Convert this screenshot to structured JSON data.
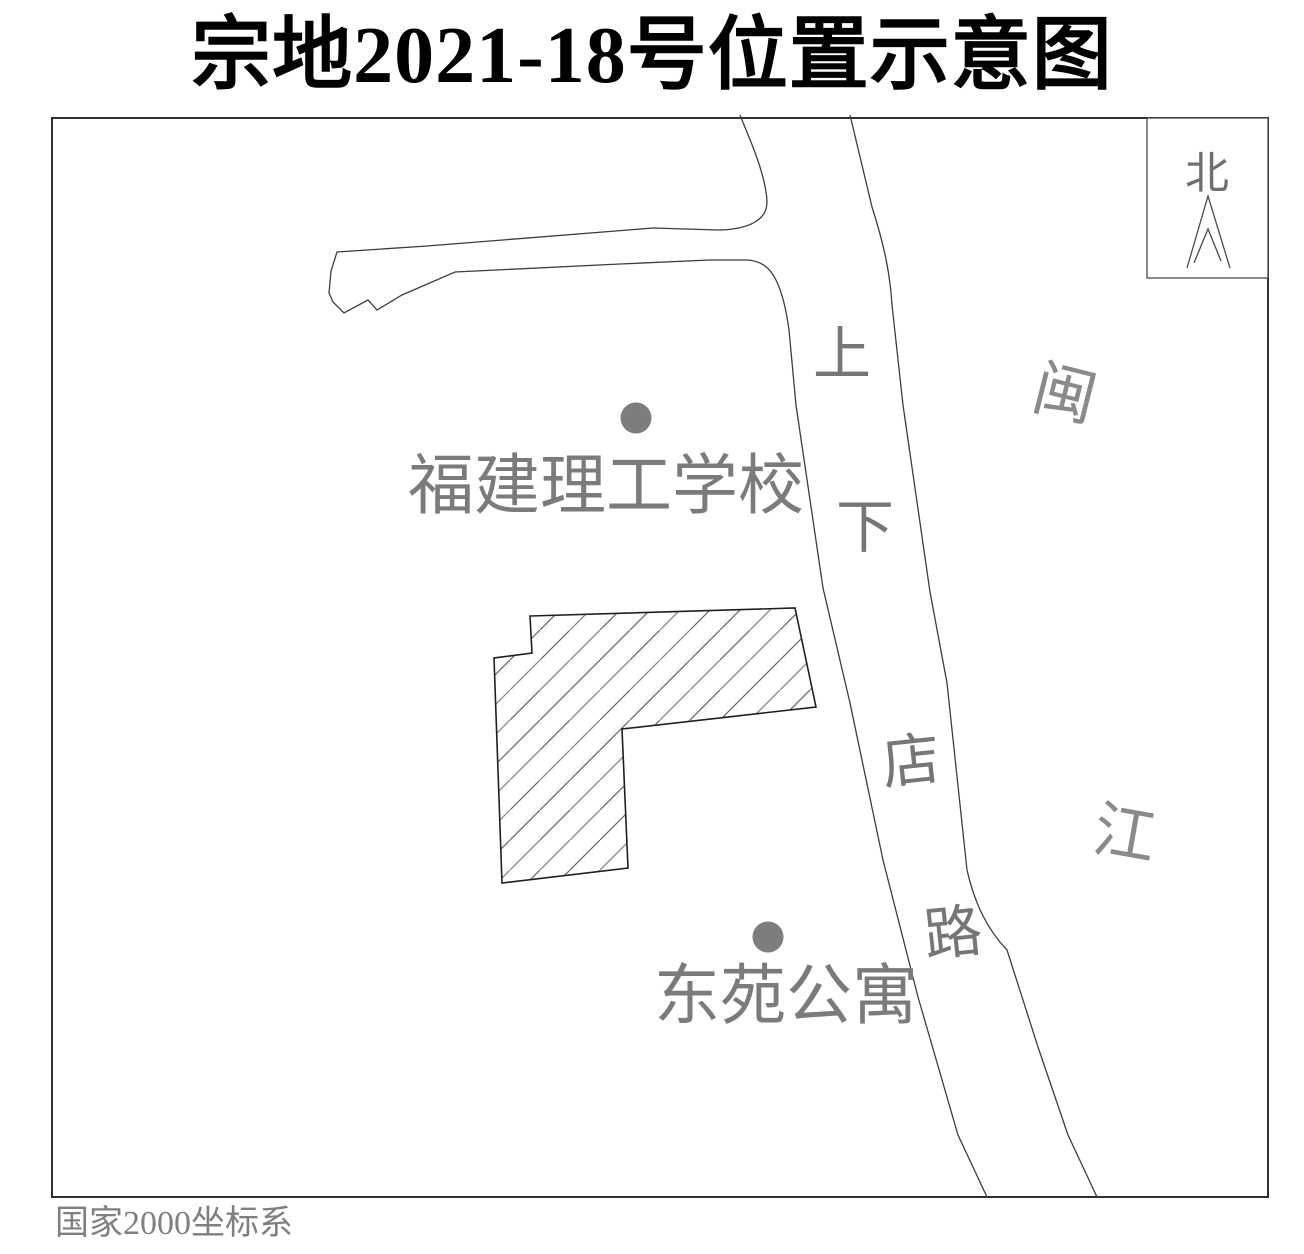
{
  "title": "宗地2021-18号位置示意图",
  "map": {
    "north_label": "北",
    "road_chars": [
      "上",
      "下",
      "店",
      "路"
    ],
    "road_name": "上下店路",
    "river_chars": [
      "闽",
      "江"
    ],
    "river_name": "闽江",
    "poi": [
      {
        "name": "福建理工学校"
      },
      {
        "name": "东苑公寓"
      }
    ],
    "parcel_name": "宗地2021-18号"
  },
  "footer": {
    "note": "国家2000坐标系"
  },
  "colors": {
    "label_gray": "#7b7b7b",
    "line_dark": "#3d3d3d",
    "hatch_gray": "#808080",
    "title_black": "#000000"
  }
}
